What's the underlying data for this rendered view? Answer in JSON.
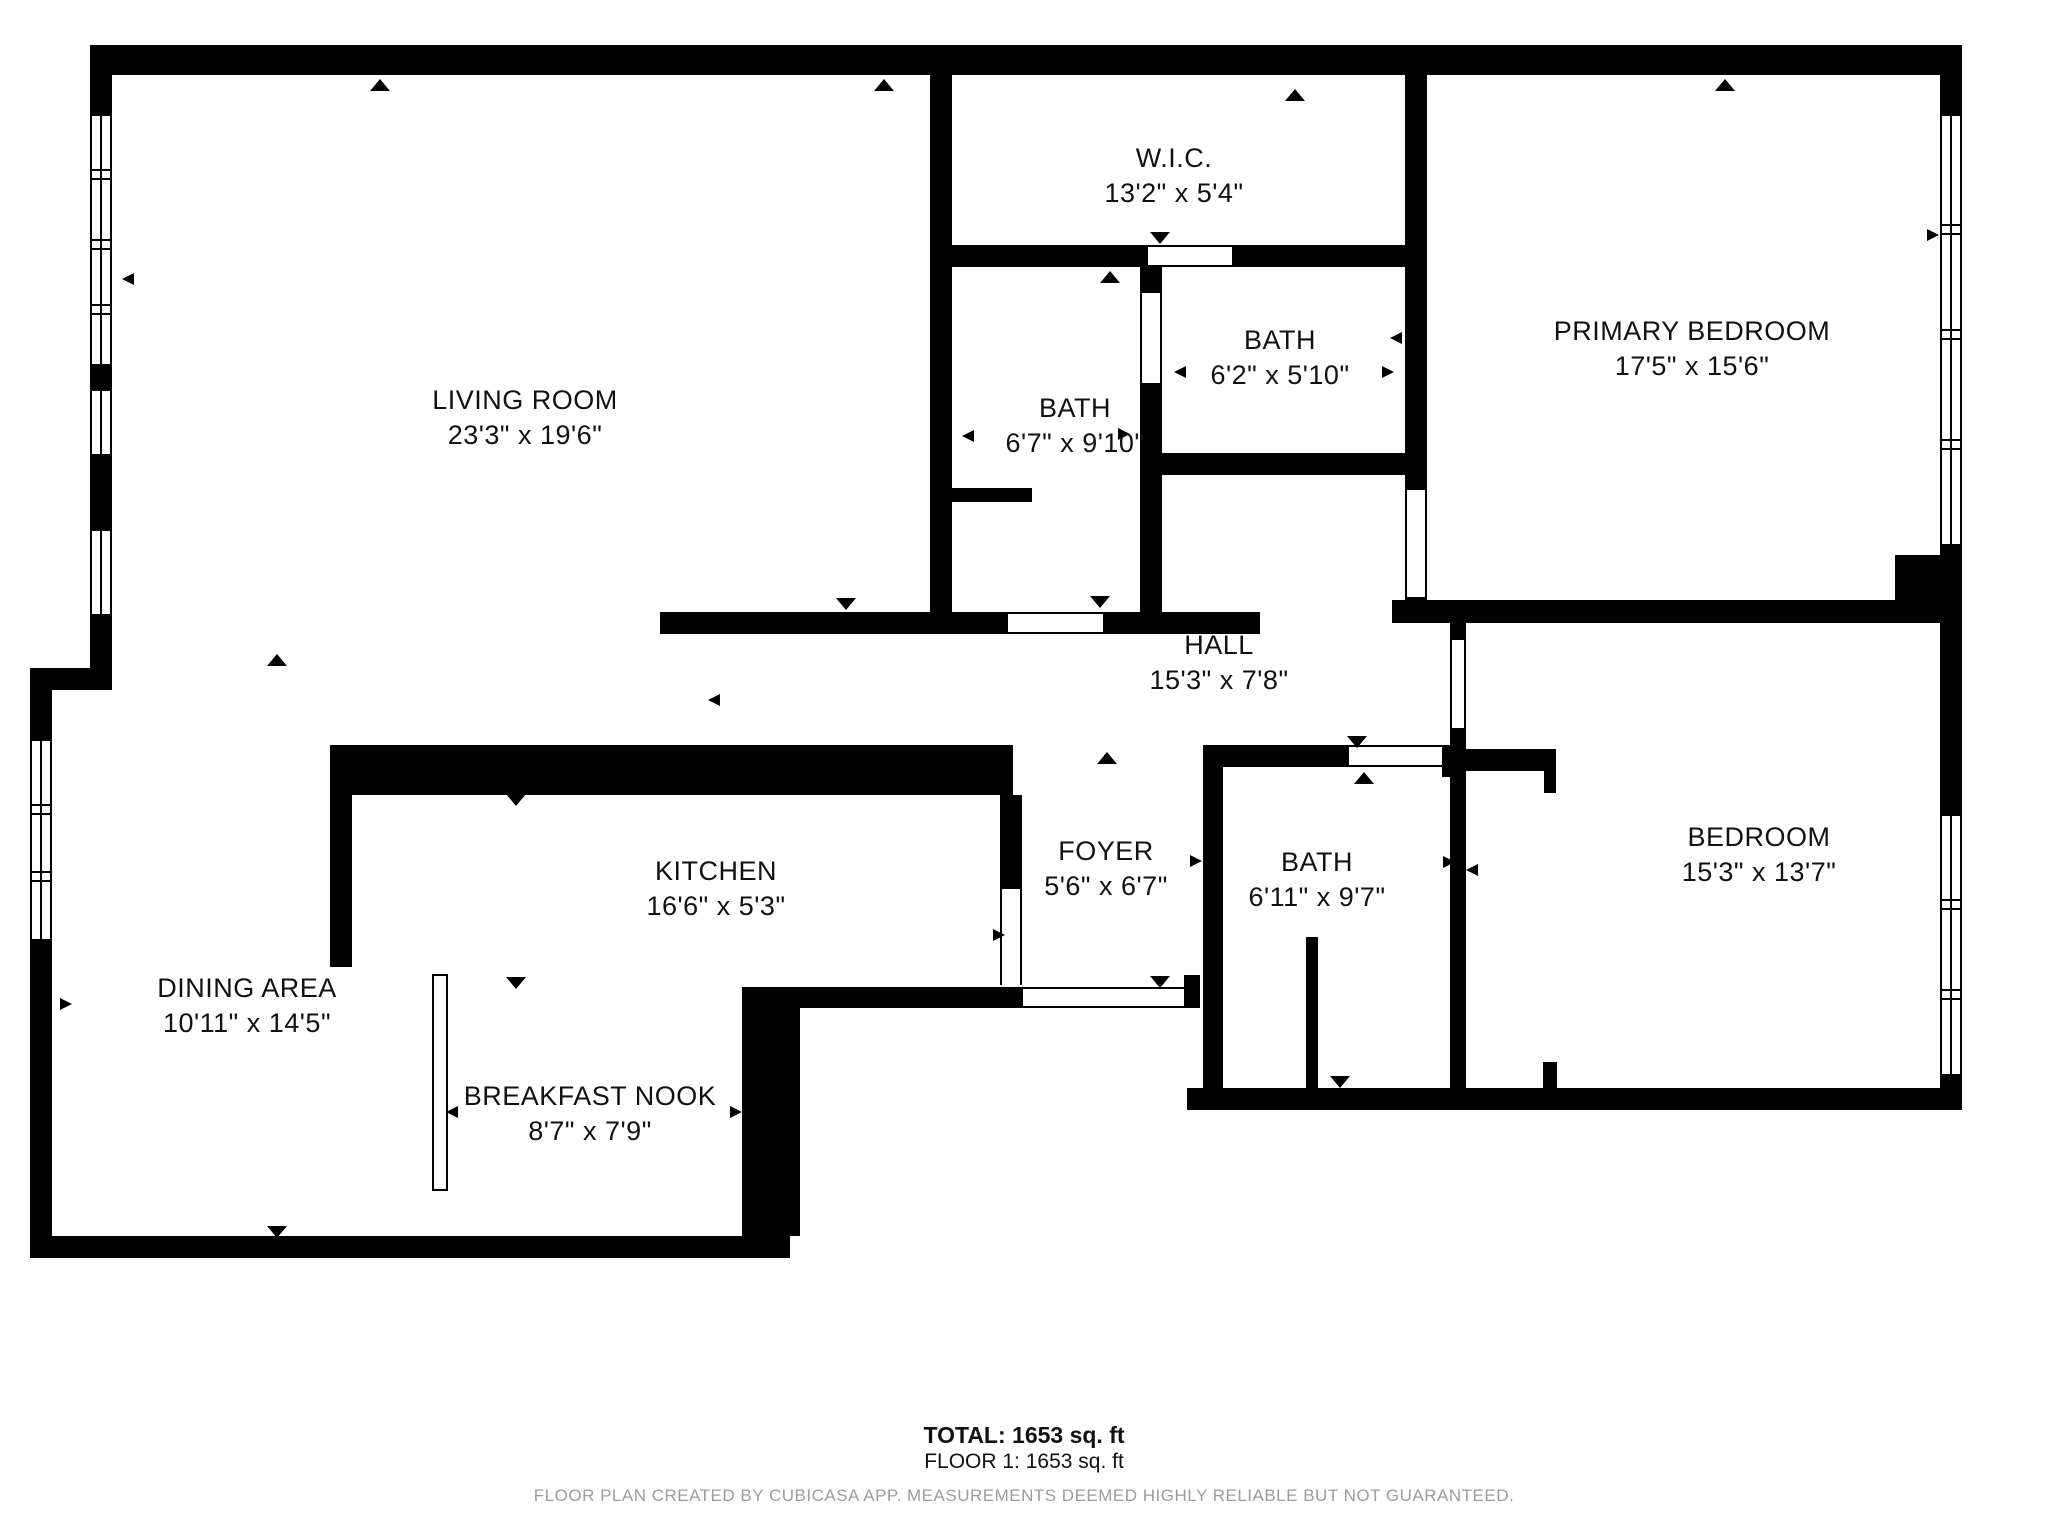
{
  "rooms": [
    {
      "name": "LIVING ROOM",
      "dims": "23'3\" x 19'6\"",
      "cx": 525,
      "cy": 418
    },
    {
      "name": "W.I.C.",
      "dims": "13'2\" x 5'4\"",
      "cx": 1174,
      "cy": 176
    },
    {
      "name": "BATH",
      "dims": "6'7\" x 9'10\"",
      "cx": 1075,
      "cy": 426
    },
    {
      "name": "BATH",
      "dims": "6'2\" x 5'10\"",
      "cx": 1280,
      "cy": 358
    },
    {
      "name": "PRIMARY BEDROOM",
      "dims": "17'5\" x 15'6\"",
      "cx": 1692,
      "cy": 349
    },
    {
      "name": "HALL",
      "dims": "15'3\" x 7'8\"",
      "cx": 1219,
      "cy": 663
    },
    {
      "name": "KITCHEN",
      "dims": "16'6\" x 5'3\"",
      "cx": 716,
      "cy": 889
    },
    {
      "name": "FOYER",
      "dims": "5'6\" x 6'7\"",
      "cx": 1106,
      "cy": 869
    },
    {
      "name": "BATH",
      "dims": "6'11\" x 9'7\"",
      "cx": 1317,
      "cy": 880
    },
    {
      "name": "BEDROOM",
      "dims": "15'3\" x 13'7\"",
      "cx": 1759,
      "cy": 855
    },
    {
      "name": "DINING AREA",
      "dims": "10'11\" x 14'5\"",
      "cx": 247,
      "cy": 1006
    },
    {
      "name": "BREAKFAST NOOK",
      "dims": "8'7\" x 7'9\"",
      "cx": 590,
      "cy": 1114
    }
  ],
  "summary": {
    "total": "TOTAL: 1653 sq. ft",
    "floor": "FLOOR 1: 1653 sq. ft"
  },
  "footer": {
    "disclaimer": "FLOOR PLAN CREATED BY CUBICASA APP. MEASUREMENTS DEEMED HIGHLY RELIABLE BUT NOT GUARANTEED."
  },
  "colors": {
    "wall": "#000000",
    "background": "#ffffff",
    "disclaimer_text": "#9c9c9c"
  },
  "icons": {
    "dimension_arrow": "small black triangle dimension marker",
    "window": "double-line window strip in wall",
    "door_opening": "white gap with thin frame lines in wall"
  }
}
